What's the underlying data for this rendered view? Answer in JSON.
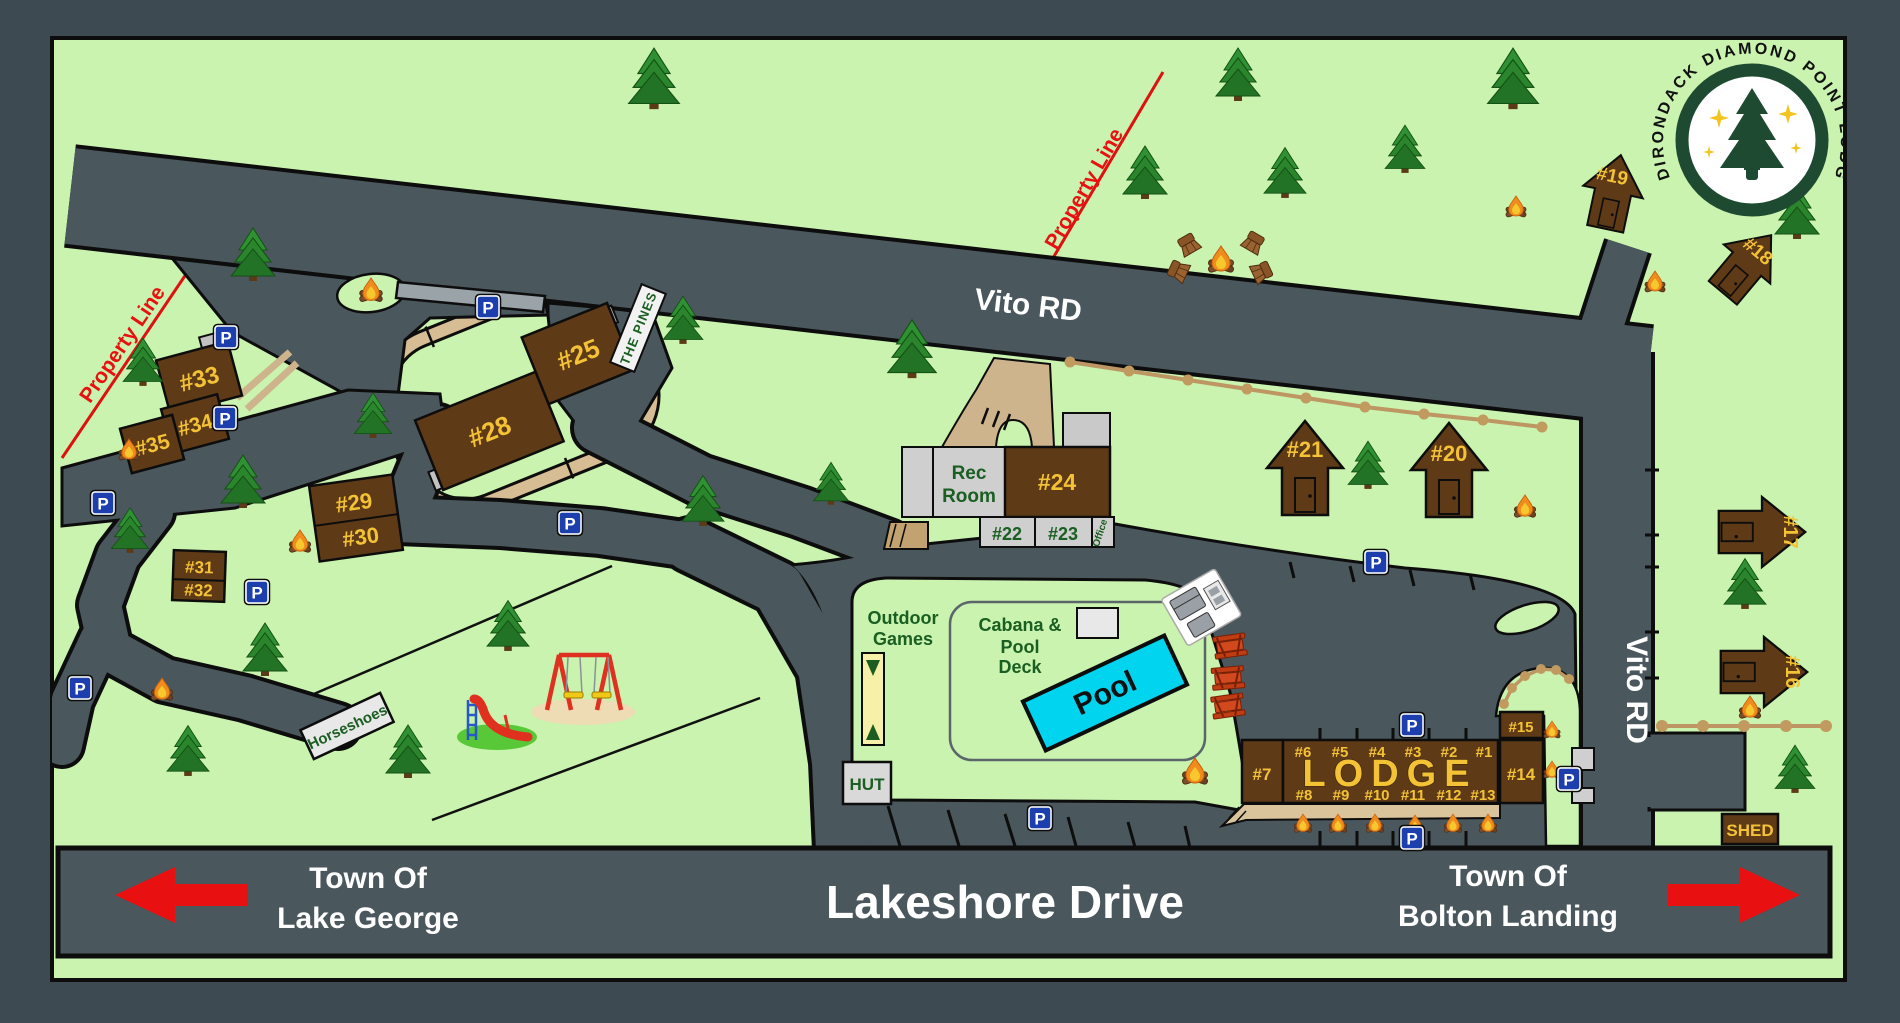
{
  "labels": {
    "p": "P",
    "vito_rd": "Vito RD",
    "lakeshore": "Lakeshore Drive",
    "town_of": "Town Of",
    "lake_george": "Lake George",
    "bolton_landing": "Bolton Landing",
    "property_line": "Property Line",
    "logo_text": "ADIRONDACK DIAMOND POINT LODGE",
    "the_pines": "THE PINES",
    "horseshoes": "Horseshoes",
    "outdoor": "Outdoor",
    "games": "Games",
    "cabana1": "Cabana &",
    "cabana2": "Pool",
    "cabana3": "Deck",
    "pool": "Pool",
    "hut": "HUT",
    "shed": "SHED",
    "office": "Office",
    "rec1": "Rec",
    "rec2": "Room",
    "lodge": "LODGE"
  },
  "units": {
    "1": "#1",
    "2": "#2",
    "3": "#3",
    "4": "#4",
    "5": "#5",
    "6": "#6",
    "7": "#7",
    "8": "#8",
    "9": "#9",
    "10": "#10",
    "11": "#11",
    "12": "#12",
    "13": "#13",
    "14": "#14",
    "15": "#15",
    "16": "#16",
    "17": "#17",
    "18": "#18",
    "19": "#19",
    "20": "#20",
    "21": "#21",
    "22": "#22",
    "23": "#23",
    "24": "#24",
    "25": "#25",
    "28": "#28",
    "29": "#29",
    "30": "#30",
    "31": "#31",
    "32": "#32",
    "33": "#33",
    "34": "#34",
    "35": "#35"
  },
  "colors": {
    "frame": "#3d4a52",
    "map_green": "#c9f3ae",
    "road": "#4a575c",
    "cabin_brown": "#5e3a17",
    "label_gold": "#f4c335",
    "sign_green": "#1a5e21",
    "pool_cyan": "#00d4ef",
    "arrow_red": "#e81010",
    "parking_blue": "#1d3fae",
    "path_tan": "#cdb48c",
    "fence_tan": "#bd9663",
    "logo_green": "#1d4a30"
  }
}
